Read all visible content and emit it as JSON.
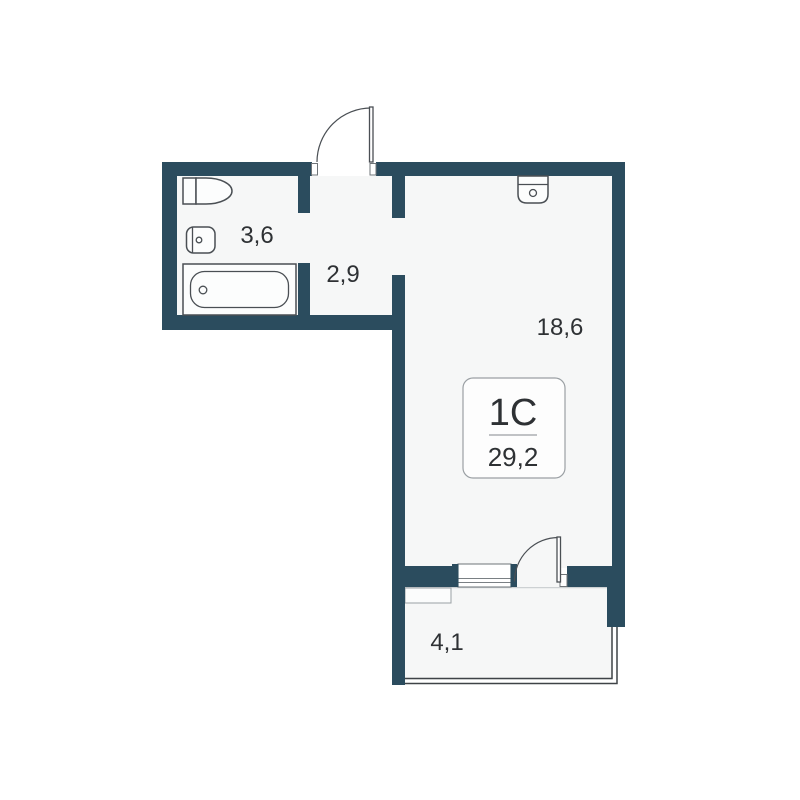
{
  "floor_plan": {
    "unit_type": "1С",
    "total_area": "29,2",
    "rooms": [
      {
        "name": "bathroom",
        "area": "3,6"
      },
      {
        "name": "hallway",
        "area": "2,9"
      },
      {
        "name": "living-room",
        "area": "18,6"
      },
      {
        "name": "balcony",
        "area": "4,1"
      }
    ],
    "fixtures": [
      "toilet-icon",
      "washbasin-icon",
      "bathtub-icon",
      "kitchen-sink-icon"
    ],
    "doors": [
      "entrance-door",
      "balcony-door"
    ],
    "windows": [
      "balcony-window"
    ]
  },
  "colors": {
    "wall": "#2B4C5E",
    "room_fill": "#F6F7F7",
    "background": "#FFFFFF",
    "fixture_stroke": "#4A4F54",
    "glazing_stroke": "#3F4347",
    "text": "#2E3134",
    "info_border": "#9BA0A4",
    "window_frame": "#7A8084"
  }
}
